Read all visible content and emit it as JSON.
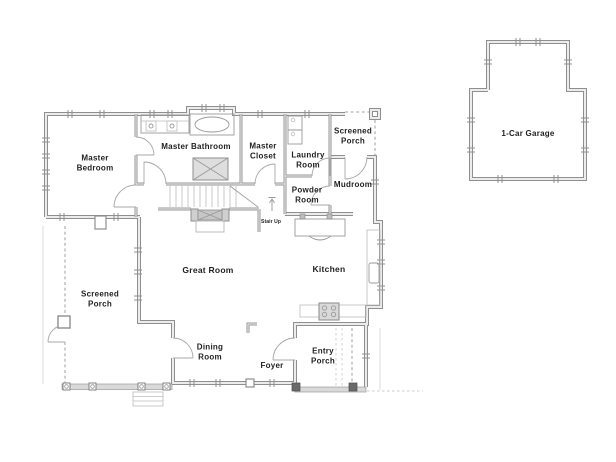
{
  "floor_plan": {
    "rooms": {
      "master_bedroom": "Master\nBedroom",
      "master_bathroom": "Master Bathroom",
      "master_closet": "Master\nCloset",
      "laundry_room": "Laundry\nRoom",
      "screened_porch_upper": "Screened\nPorch",
      "mudroom": "Mudroom",
      "powder_room": "Powder\nRoom",
      "stair_up": "Stair Up",
      "great_room": "Great Room",
      "kitchen": "Kitchen",
      "screened_porch_lower": "Screened\nPorch",
      "dining_room": "Dining\nRoom",
      "foyer": "Foyer",
      "entry_porch": "Entry\nPorch",
      "garage": "1-Car Garage"
    },
    "colors": {
      "background": "#ffffff",
      "wall": "#8f8f8f",
      "screen_dash": "#b5b5b5",
      "label_text": "#1f1f1f"
    }
  }
}
